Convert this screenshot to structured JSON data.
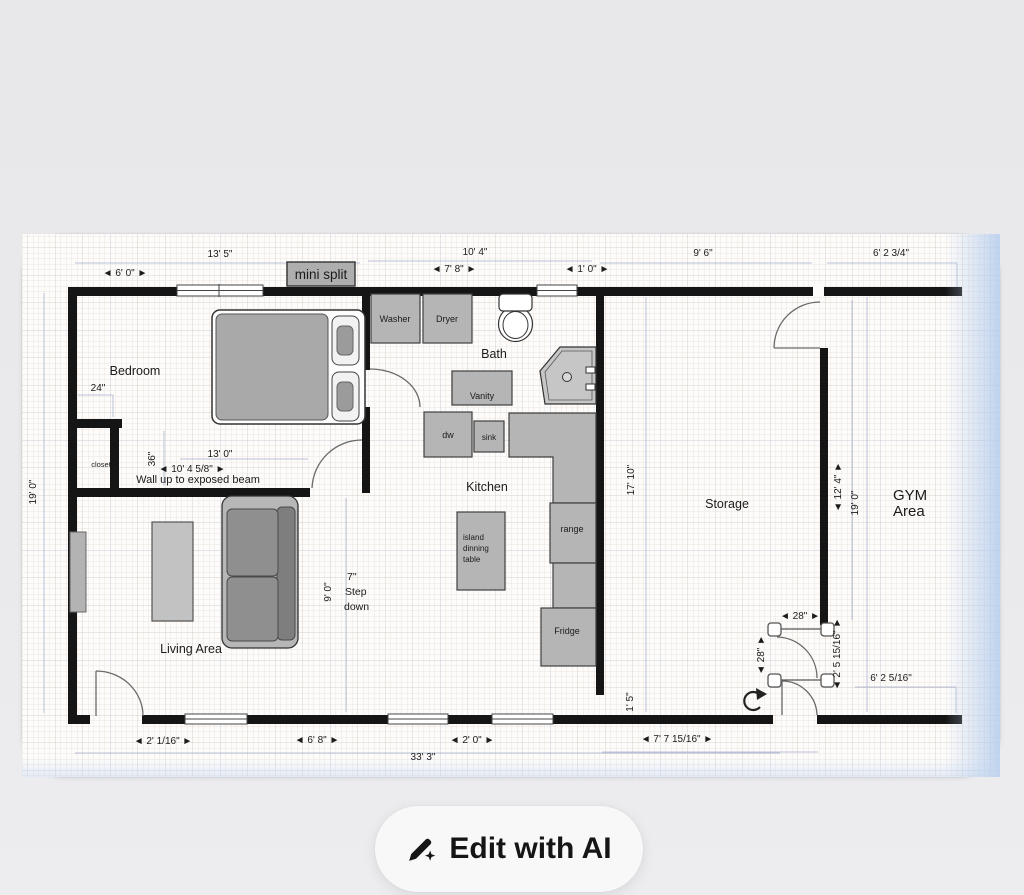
{
  "app": {
    "edit_button": {
      "label": "Edit with AI",
      "icon": "pencil-sparkle-icon"
    }
  },
  "colors": {
    "wall": "#151515",
    "paper": "#fdfcfb",
    "furniture_fill": "#b5b5b5",
    "guide_blue": "#afb9d1",
    "page_bg": "#e9e9eb",
    "button_bg": "#f8f8f9"
  },
  "plan": {
    "room_labels": {
      "bedroom": "Bedroom",
      "closet": "closet",
      "bath": "Bath",
      "kitchen": "Kitchen",
      "living": "Living Area",
      "storage": "Storage",
      "gym_line1": "GYM",
      "gym_line2": "Area"
    },
    "annotations": {
      "mini_split": "mini split",
      "wall_note": "Wall up to exposed beam",
      "step_line1": "7\"",
      "step_line2": "Step",
      "step_line3": "down"
    },
    "furniture_labels": {
      "washer": "Washer",
      "dryer": "Dryer",
      "vanity": "Vanity",
      "dw": "dw",
      "sink": "sink",
      "island_line1": "island",
      "island_line2": "dinning",
      "island_line3": "table",
      "range": "range",
      "fridge": "Fridge"
    },
    "dimensions": {
      "top_left_overall": "13' 5\"",
      "top_window_6_0": "◄ 6' 0\" ►",
      "top_mid_overall": "10' 4\"",
      "top_7_8": "◄ 7' 8\" ►",
      "top_1_0": "◄ 1' 0\" ►",
      "top_storage": "9' 6\"",
      "top_gym": "6' 2 3/4\"",
      "left_height": "19' 0\"",
      "closet_24": "24\"",
      "closet_36": "36\"",
      "bedroom_width": "13' 0\"",
      "beam_width": "◄ 10' 4 5/8\" ►",
      "step_opening": "9' 0\"",
      "storage_height": "17' 10\"",
      "gym_opening": "◄ 12' 4\" ►",
      "gym_height": "19' 0\"",
      "door_width_h": "◄ 28\" ►",
      "door_width_v": "◄ 28\" ►",
      "door_offset": "◄ 2' 5 15/16\" ►",
      "gym_bottom": "6' 2 5/16\"",
      "storage_opening": "1' 5\"",
      "bottom_2_1": "◄ 2' 1/16\" ►",
      "bottom_6_8": "◄ 6' 8\" ►",
      "bottom_2_0": "◄ 2' 0\" ►",
      "bottom_overall": "33' 3\"",
      "bottom_right": "◄ 7' 7 15/16\" ►"
    }
  }
}
